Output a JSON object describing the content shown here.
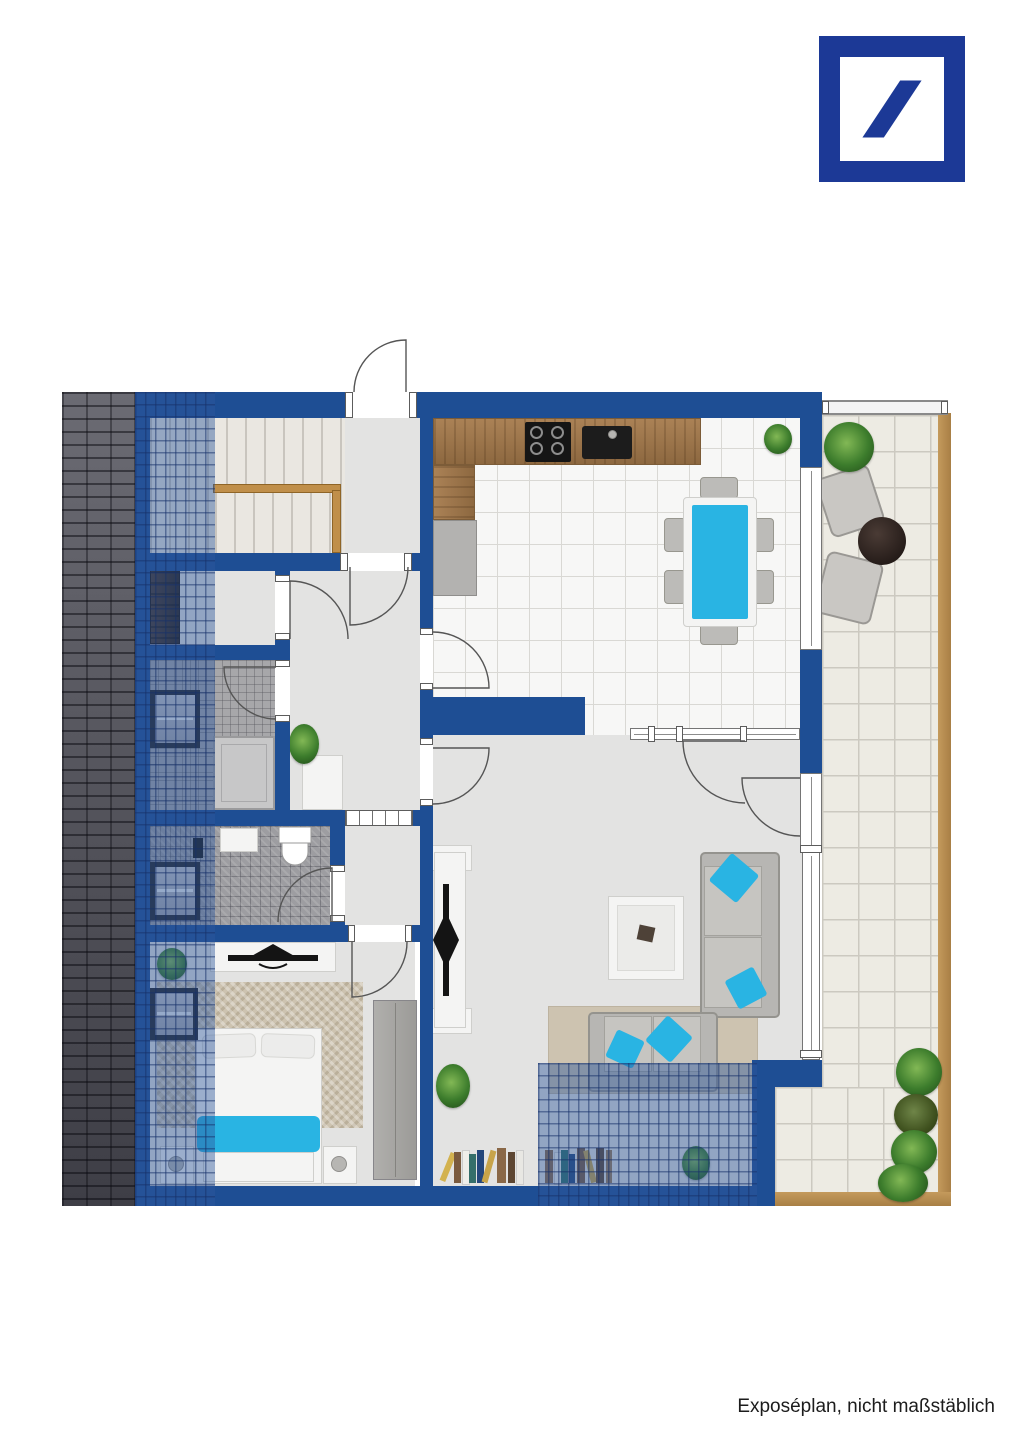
{
  "caption": {
    "text": "Exposéplan, nicht maßstäblich"
  },
  "logo": {
    "name": "deutsche-bank-logo",
    "shape": "square-frame-with-slash"
  },
  "colors": {
    "wall": "#1e4e94",
    "logo_blue": "#1c3996",
    "accent_cyan": "#29b4e3",
    "roof_overlay": "#2f589e",
    "terrace_tile": "#edebe3",
    "terrace_border": "#b78e4f",
    "floor_light": "#e3e3e2",
    "kitchen_floor": "#f7f7f6",
    "grid_line": "#d9d8d4",
    "bath_tile": "#a7a7aa",
    "slab_gray": "#b3b2b0",
    "sofa_gray": "#b7b6b3",
    "cushion_gray": "#c6c5c1",
    "rug_beige": "#cdc3b0",
    "stair_rail": "#c08f4a",
    "furniture_white": "#f4f4f3",
    "plant_green": "#3e7a2e",
    "table_dark": "#2c2320",
    "tv_black": "#141414"
  },
  "plan": {
    "type": "apartment-floor-plan",
    "rooms": [
      "staircase",
      "hallway",
      "storage-room",
      "bathroom-upper",
      "bathroom-lower",
      "bedroom",
      "kitchen-dining",
      "living-room",
      "terrace",
      "roof-slope"
    ],
    "furniture": [
      "stairs-with-wood-rail",
      "wardrobe-cabinet",
      "roof-windows",
      "shower",
      "washbasins",
      "toilet",
      "double-bed-cyan-throw",
      "nightstands",
      "tv-sideboards",
      "dining-table-cyan",
      "six-dining-chairs",
      "cooktop",
      "kitchen-sink",
      "corner-sofa-cyan-pillows",
      "two-seater-sofa",
      "coffee-table",
      "terrace-armchairs",
      "round-side-table",
      "plants",
      "books"
    ]
  }
}
